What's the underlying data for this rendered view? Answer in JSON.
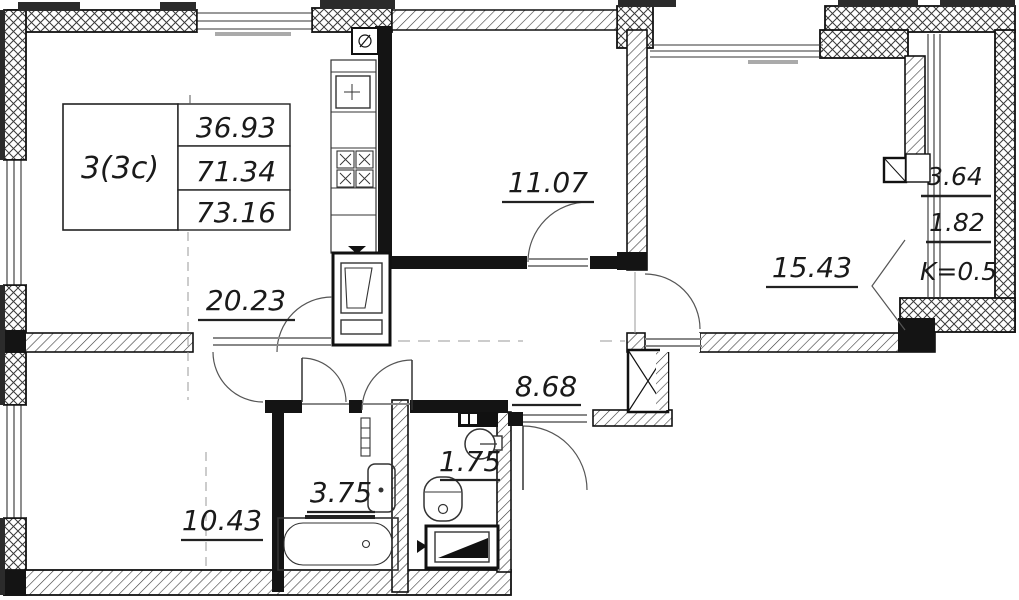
{
  "plan": {
    "stamp": {
      "type": "3(3c)",
      "living_area": "36.93",
      "apartment_area": "71.34",
      "total_area": "73.16"
    },
    "rooms": {
      "kitchen_living": "20.23",
      "bedroom_top": "11.07",
      "room_right": "15.43",
      "hall": "8.68",
      "bedroom_bottom": "10.43",
      "bathroom": "3.75",
      "wc": "1.75",
      "balcony_area": "3.64",
      "balcony_reduced": "1.82",
      "balcony_coefficient": "K=0.5"
    },
    "symbols": [
      "kitchen-sink-icon",
      "stove-icon",
      "fridge-icon",
      "vent-icon",
      "bathtub-icon",
      "washbasin-icon",
      "toilet-icon",
      "corner-sink-icon",
      "washing-machine-icon",
      "vent-shaft-icon",
      "towel-radiator-icon"
    ]
  }
}
